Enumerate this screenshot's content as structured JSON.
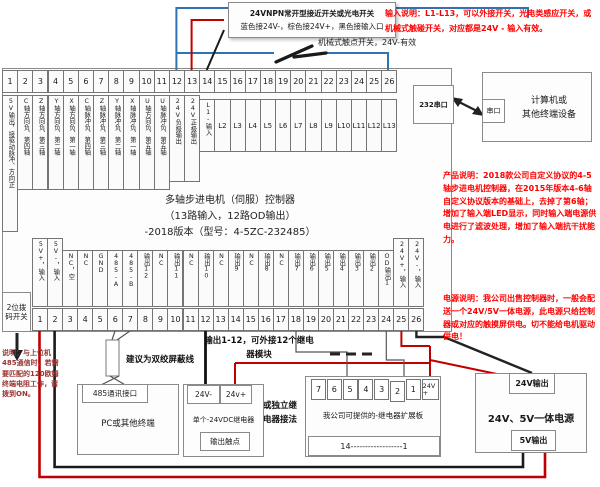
{
  "colors": {
    "wire_blue": "#2e74b5",
    "wire_red": "#c00000",
    "wire_black": "#1a1a1a",
    "annotation_red": "#ff0000",
    "dip_note_red": "#993333"
  },
  "notes": {
    "sensor_box_line1": "24VNPN常开型接近开关或光电开关",
    "sensor_box_line2": "蓝色接24V-，棕色接24V+，黑色接输入口",
    "mech_switch": "机械式触点开关，24V-有效",
    "input_note": "输入说明：L1-L13，可以外接开关，光电类感应开关，或机械式触碰开关，对应都是24V - 输入有效。",
    "product_note": "产品说明：2018款公司自定义协议的4-5轴步进电机控制器，在2015年版本4-6轴自定义协议版本的基础上，去掉了第6轴；增加了输入端LED显示，同时输入端电源供电进行了滤波处理，增加了输入端抗干扰能力。",
    "power_note": "电源说明：我公司出售控制器时，一般会配送一个24V/5V一体电源，此电源只给控制器或对应的触摸屏供电。切不能给电机驱动供电！",
    "dip_note": "说明：与上位机485通信时，若需要匹配的120欧姆终端电阻工作，请拨到ON。",
    "output_note": "输出1-12，可外接12个继电器模块",
    "twisted_pair": "建议为双绞屏蔽线",
    "alt_relay": "或独立继电器接法"
  },
  "controller": {
    "title_line1": "多轴步进电机（伺服）控制器",
    "title_line2": "（13路输入，12路OD输出）",
    "title_line3": "-2018版本（型号：4-5ZC-232485）",
    "serial_port": "232串口",
    "dip_switch": "2位拨码开关",
    "top_terminals": [
      {
        "num": "1",
        "label": "5V输出，接驱动脉冲、方向正"
      },
      {
        "num": "2",
        "label": "C轴方向负、第四轴"
      },
      {
        "num": "3",
        "label": "Z轴方向负、第三轴"
      },
      {
        "num": "4",
        "label": "Y轴方向负、第二轴"
      },
      {
        "num": "5",
        "label": "X轴方向负、第一轴"
      },
      {
        "num": "6",
        "label": "C轴脉冲负、第四轴"
      },
      {
        "num": "7",
        "label": "Z轴脉冲负、第三轴"
      },
      {
        "num": "8",
        "label": "Y轴脉冲负、第二轴"
      },
      {
        "num": "9",
        "label": "X轴脉冲负、第一轴"
      },
      {
        "num": "10",
        "label": "U轴方向负、第五轴"
      },
      {
        "num": "11",
        "label": "U轴脉冲负、第五轴"
      },
      {
        "num": "12",
        "label": "24V负极输出"
      },
      {
        "num": "13",
        "label": "24V正极输出"
      },
      {
        "num": "14",
        "label": "L1-输入"
      },
      {
        "num": "15",
        "label": "L2"
      },
      {
        "num": "16",
        "label": "L3"
      },
      {
        "num": "17",
        "label": "L4"
      },
      {
        "num": "18",
        "label": "L5"
      },
      {
        "num": "19",
        "label": "L6"
      },
      {
        "num": "20",
        "label": "L7"
      },
      {
        "num": "21",
        "label": "L8"
      },
      {
        "num": "22",
        "label": "L9"
      },
      {
        "num": "23",
        "label": "L10"
      },
      {
        "num": "24",
        "label": "L11"
      },
      {
        "num": "25",
        "label": "L12"
      },
      {
        "num": "26",
        "label": "L13"
      }
    ],
    "bottom_terminals": [
      {
        "num": "1",
        "label": "5V+，输入"
      },
      {
        "num": "2",
        "label": "5V-，输入"
      },
      {
        "num": "3",
        "label": "NC，空"
      },
      {
        "num": "4",
        "label": "NC"
      },
      {
        "num": "5",
        "label": "GND"
      },
      {
        "num": "6",
        "label": "485-A"
      },
      {
        "num": "7",
        "label": "485-B"
      },
      {
        "num": "8",
        "label": "输出12"
      },
      {
        "num": "9",
        "label": "NC"
      },
      {
        "num": "10",
        "label": "输出11"
      },
      {
        "num": "11",
        "label": "NC"
      },
      {
        "num": "12",
        "label": "输出10"
      },
      {
        "num": "13",
        "label": "NC"
      },
      {
        "num": "14",
        "label": "输出9"
      },
      {
        "num": "15",
        "label": "NC"
      },
      {
        "num": "16",
        "label": "输出8"
      },
      {
        "num": "17",
        "label": "NC"
      },
      {
        "num": "18",
        "label": "输出7"
      },
      {
        "num": "19",
        "label": "输出6"
      },
      {
        "num": "20",
        "label": "输出5"
      },
      {
        "num": "21",
        "label": "输出4"
      },
      {
        "num": "22",
        "label": "输出3"
      },
      {
        "num": "23",
        "label": "输出2"
      },
      {
        "num": "24",
        "label": "OD输出1"
      },
      {
        "num": "25",
        "label": "24V+，输入"
      },
      {
        "num": "26",
        "label": "24V-，输入"
      }
    ]
  },
  "peripherals": {
    "computer": {
      "port": "串口",
      "name_line1": "计算机或",
      "name_line2": "其他终端设备"
    },
    "pc_485": {
      "port": "485通讯接口",
      "name": "PC或其他终端"
    },
    "single_relay": {
      "neg": "24V-",
      "pos": "24v+",
      "name": "单个-24VDC继电器",
      "contact": "输出触点"
    },
    "relay_board": {
      "terminals": [
        "7",
        "6",
        "5",
        "4",
        "3",
        "2",
        "1",
        "24V+"
      ],
      "name": "我公司可提供的-继电器扩展板",
      "bottom_label": "14------------------1"
    },
    "power_supply": {
      "out_24v": "24V输出",
      "name": "24V、5V一体电源",
      "out_5v": "5V输出"
    }
  }
}
